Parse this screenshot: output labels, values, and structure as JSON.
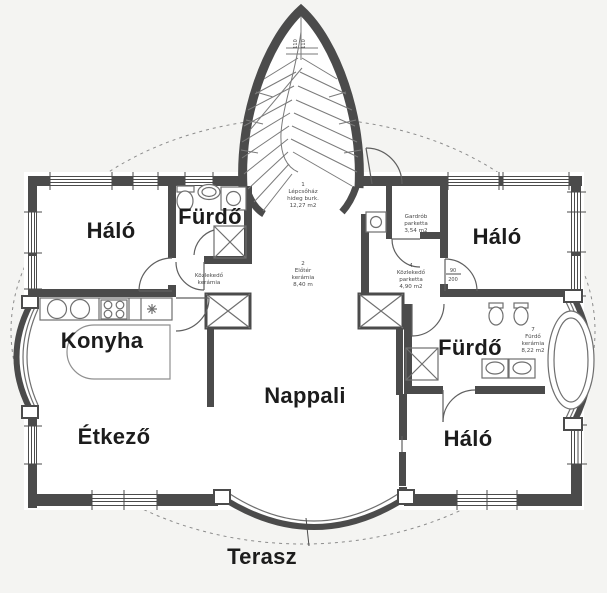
{
  "rooms": {
    "bedroom_top_left": "Háló",
    "bathroom_top_left": "Fürdő",
    "bedroom_top_right": "Háló",
    "kitchen": "Konyha",
    "bathroom_right": "Fürdő",
    "living_room": "Nappali",
    "dining_room": "Étkező",
    "bedroom_bottom_right": "Háló",
    "terrace": "Terasz"
  },
  "schedule": {
    "staircase": {
      "no": "1",
      "name": "Lépcsőház",
      "finish": "hideg burk.",
      "area": "12,27 m2"
    },
    "hall": {
      "no": "2",
      "name": "Előtér",
      "finish": "kerámia",
      "area": "8,40 m"
    },
    "corridor_left": {
      "name": "Közlekedő",
      "finish": "kerámia"
    },
    "wardrobe": {
      "name": "Gardrób",
      "finish": "parketta",
      "area": "3,54 m2"
    },
    "corridor_right": {
      "no": "4",
      "name": "Közlekedő",
      "finish": "parketta",
      "area": "4,90 m2"
    },
    "bathroom_7": {
      "no": "7",
      "name": "Fürdő",
      "finish": "kerámia",
      "area": "8,22 m2"
    }
  },
  "dimensions": {
    "tower_window_left": "110",
    "tower_window_right": "110",
    "door_width": "90",
    "door_height": "200"
  },
  "colors": {
    "wall": "#4b4b4b",
    "fixture": "#6f6f6f",
    "label": "#1c1c1c",
    "background": "#f4f4f2",
    "room": "#ffffff",
    "dashed_line": "#8c8c8c"
  }
}
